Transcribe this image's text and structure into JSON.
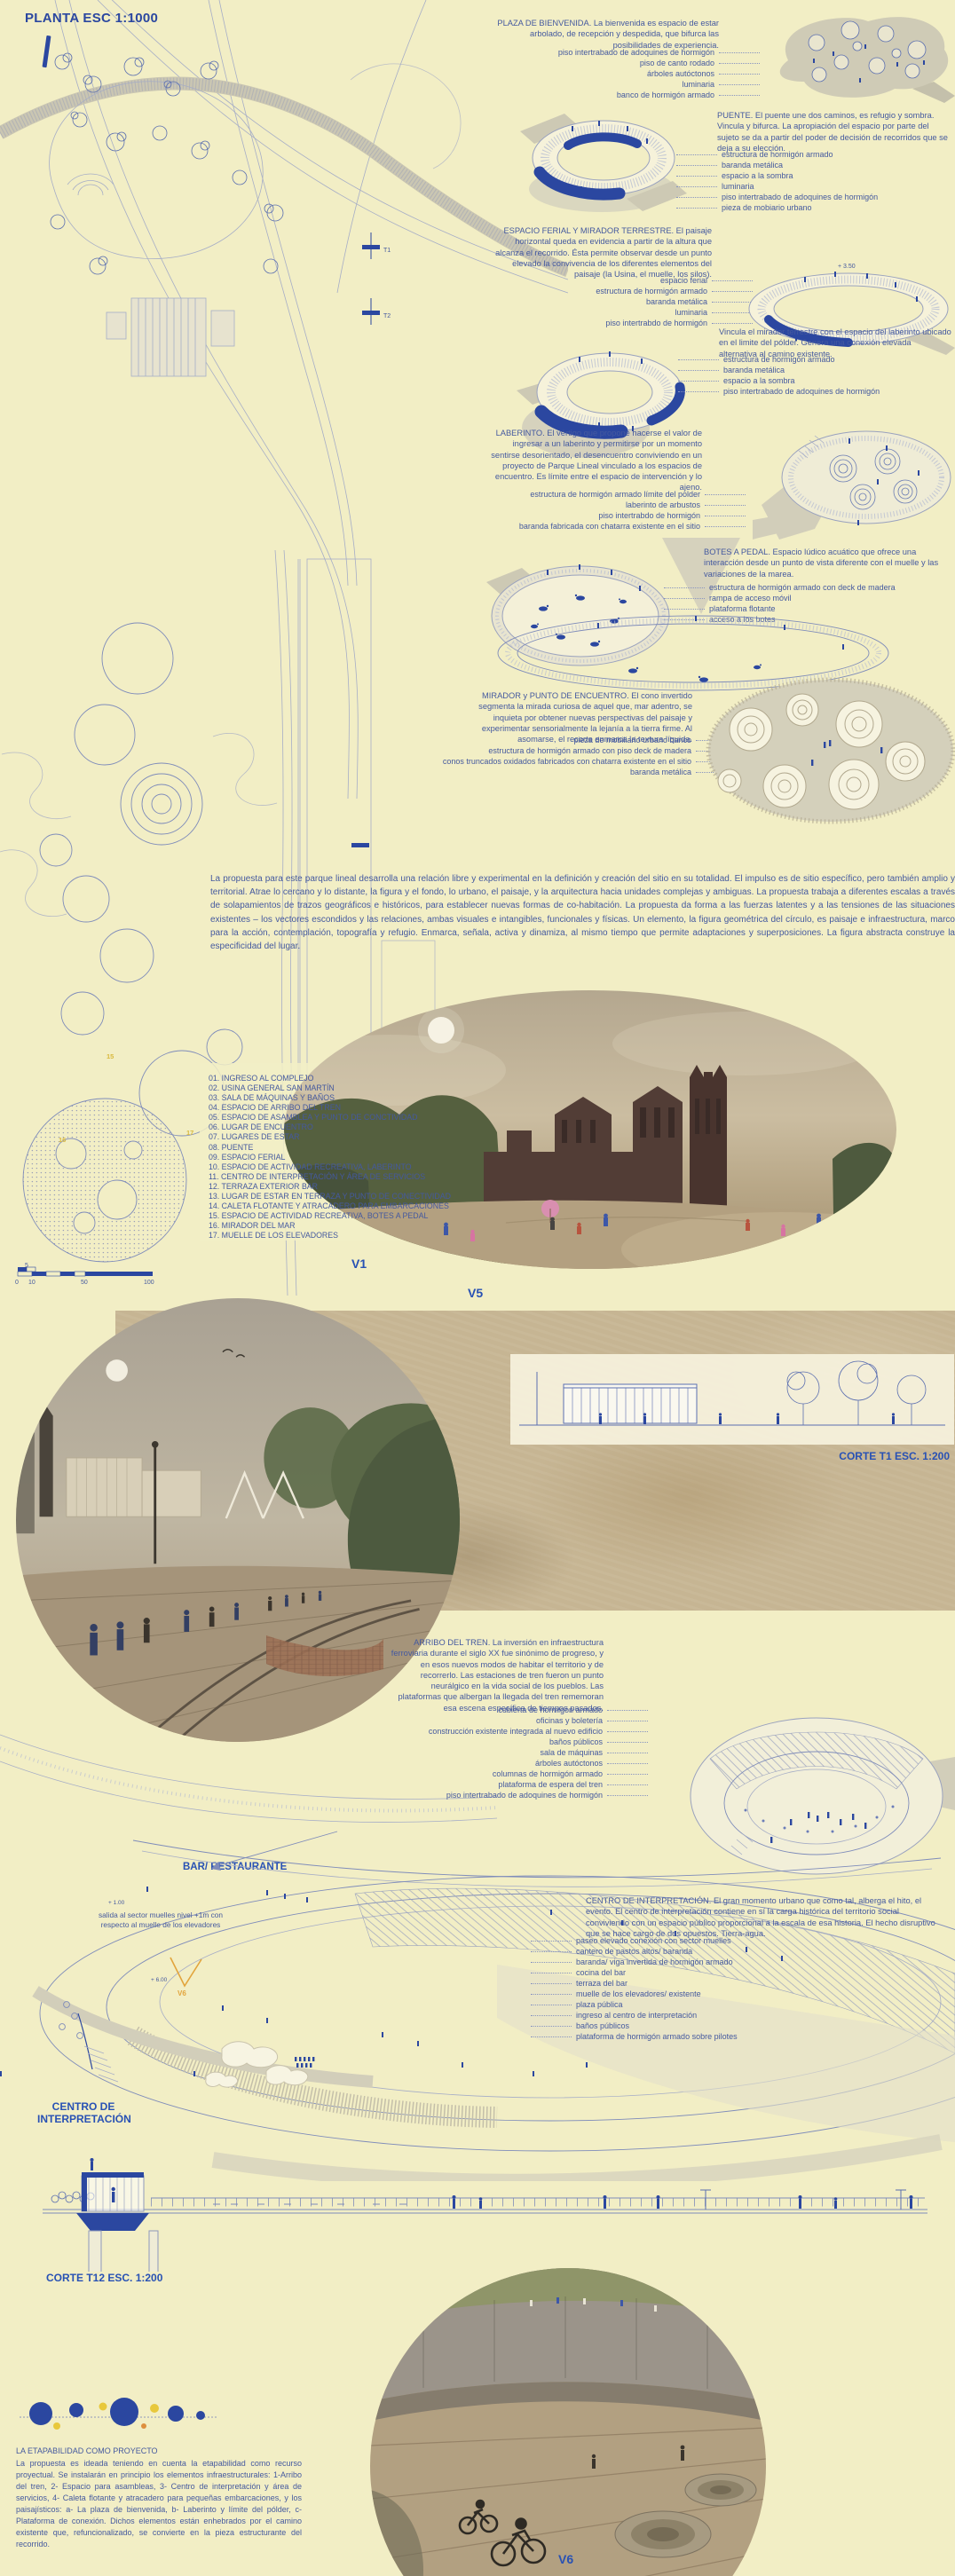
{
  "colors": {
    "background": "#f2eec5",
    "accent_blue": "#2b47a0",
    "text_blue": "#44599f",
    "band_tan": "#c6b593",
    "highlight_yellow": "#d9b93e",
    "marker_orange": "#e2a43c"
  },
  "plan": {
    "title": "PLANTA ESC 1:1000",
    "markers": [
      "15",
      "16",
      "17"
    ],
    "sections": [
      "T1",
      "T2"
    ]
  },
  "scalebar": {
    "top": "5",
    "ticks": [
      "0",
      "10",
      "50",
      "100"
    ]
  },
  "blocks": {
    "plaza": {
      "text": "PLAZA DE BIENVENIDA. La bienvenida es espacio de estar arbolado, de recepción y despedida, que bifurca las posibilidades de experiencia.",
      "labels": [
        "piso intertrabado de adoquines de hormigón",
        "piso de canto rodado",
        "árboles autóctonos",
        "luminaria",
        "banco de hormigón armado"
      ]
    },
    "puente": {
      "text": "PUENTE. El puente une dos caminos, es refugio y sombra. Vincula y bifurca. La apropiación del espacio por parte del sujeto se da a partir del poder de decisión de recorridos que se deja a su elección.",
      "labels": [
        "estructura de hormigón armado",
        "baranda metálica",
        "espacio a la sombra",
        "luminaria",
        "piso intertrabado de adoquines de hormigón",
        "pieza de mobiario urbano"
      ]
    },
    "ferial": {
      "text": "ESPACIO FERIAL Y MIRADOR TERRESTRE. El paisaje horizontal queda en evidencia a partir de la altura que alcanza el recorrido. Ésta permite observar desde un punto elevado la convivencia de los diferentes elementos del paisaje (la Usina, el muelle, los silos).",
      "labels": [
        "espacio ferial",
        "estructura de hormigón armado",
        "baranda metálica",
        "luminaria",
        "piso intertrabdo de hormigón"
      ],
      "elev": "+ 3.50"
    },
    "vincula": {
      "text": "Vincula el mirador terrestre con el espacio del laberinto ubicado en el limite del pólder. Genera una conexión elevada alternativa al camino existente.",
      "labels": [
        "estructura de hormigón armado",
        "baranda metálica",
        "espacio a la sombra",
        "piso intertrabado de adoquines de hormigón"
      ]
    },
    "laberinto": {
      "text": "LABERINTO. El vértigo que propone hacerse el valor de ingresar a un laberinto y permitirse por un momento sentirse desorientado, el desencuentro conviviendo en un proyecto de Parque Lineal vinculado a los espacios de encuentro. Es límite entre el espacio de intervención y lo ajeno.",
      "labels": [
        "estructura de hormigón armado límite del polder",
        "laberinto de arbustos",
        "piso intertrabdo de hormigón",
        "baranda fabricada con chatarra existente en el sitio"
      ]
    },
    "botes": {
      "text": "BOTES A PEDAL. Espacio lúdico acuático que ofrece una interacción desde un punto de vista diferente con el muelle y las variaciones de la marea.",
      "labels": [
        "estructura de hormigón armado con deck de madera",
        "rampa de acceso móvil",
        "plataforma flotante",
        "acceso a los botes"
      ]
    },
    "mirador": {
      "text": "MIRADOR y PUNTO DE ENCUENTRO. El cono invertido segmenta la mirada curiosa de aquel que, mar adentro, se inquieta por obtener nuevas perspectivas del paisaje y experimentar sensorialmente la lejanía a la tierra firme. Al asomarse, el recorte enmarca la textura líquida.",
      "labels": [
        "pieza de mobiliario urbano banco",
        "estructura de hormigón armado con piso deck de madera",
        "conos truncados oxidados fabricados con chatarra existente en el sitio",
        "baranda metálica"
      ]
    },
    "arribo": {
      "text": "ARRIBO DEL TREN. La inversión en infraestructura ferroviaria durante el siglo XX fue sinónimo de progreso, y en esos nuevos modos de habitar el territorio y de recorrerlo. Las estaciones de tren fueron un punto neurálgico en la vida social de los pueblos. Las plataformas que albergan la llegada del tren rememoran esa escena específica de tiempos pasados.",
      "labels": [
        "cubierta de hormigón armado",
        "oficinas y boletería",
        "construcción existente integrada al nuevo edificio",
        "baños públicos",
        "sala de máquinas",
        "árboles autóctonos",
        "columnas de hormigón armado",
        "plataforma de espera del tren",
        "piso intertrabado de adoquines de hormigón"
      ]
    },
    "centro": {
      "text": "CENTRO DE INTERPRETACIÓN. El gran momento urbano que como tal, alberga el hito, el evento. El centro de interpretación contiene en sí la carga histórica del territorio social conviviendo con un espacio público proporcional a la escala de esa historia. El hecho disruptivo que se hace cargo de dos opuestos. Tierra-agua.",
      "labels": [
        "paseo elevado conexión con sector muelles",
        "cantero de pastos altos/ baranda",
        "baranda/ viga invertida de hormigón armado",
        "cocina del bar",
        "terraza del bar",
        "muelle de los elevadores/ existente",
        "plaza pública",
        "ingreso al centro de interpretación",
        "baños públicos",
        "plataforma de hormigón armado sobre pilotes"
      ]
    }
  },
  "intro": {
    "text": "La propuesta para este parque lineal desarrolla una relación libre y experimental en la definición y creación del sitio en su totalidad. El impulso es de sitio específico, pero también amplio y territorial. Atrae lo cercano y lo distante, la figura y el fondo, lo urbano, el paisaje, y la arquitectura hacia unidades complejas y ambiguas. La propuesta trabaja a diferentes escalas a través de solapamientos de trazos geográficos e históricos, para establecer nuevas formas de co-habitación. La propuesta da forma a las fuerzas latentes y a las tensiones de las situaciones existentes – los vectores escondidos y las relaciones, ambas visuales e intangibles, funcionales y físicas. Un elemento, la figura geométrica del círculo, es paisaje e infraestructura, marco para la acción, contemplación, topografía y refugio. Enmarca, señala, activa y dinamiza, al mismo tiempo que permite adaptaciones y superposiciones. La figura abstracta construye la especificidad del lugar."
  },
  "legend": {
    "items": [
      "01. INGRESO AL COMPLEJO",
      "02. USINA GENERAL SAN MARTÍN",
      "03. SALA DE MÁQUINAS Y BAÑOS",
      "04. ESPACIO DE ARRIBO DEL TREN",
      "05. ESPACIO DE ASAMBLEA Y PUNTO DE CONCTIVIDAD",
      "06. LUGAR DE ENCUENTRO",
      "07. LUGARES DE ESTAR",
      "08. PUENTE",
      "09. ESPACIO FERIAL",
      "10. ESPACIO DE ACTIVIDAD RECREATIVA, LABERINTO",
      "11. CENTRO DE INTERPRETACIÓN Y ÁREA DE SERVICIOS",
      "12. TERRAZA EXTERIOR BAR",
      "13. LUGAR DE ESTAR EN TERRAZA Y PUNTO DE CONECTIVIDAD",
      "14. CALETA FLOTANTE Y ATRACADERO PARA EMBARCACIONES",
      "15. ESPACIO DE ACTIVIDAD RECREATIVA, BOTES A PEDAL",
      "16. MIRADOR DEL MAR",
      "17. MUELLE DE LOS ELEVADORES"
    ]
  },
  "views": {
    "v1": "V1",
    "v5": "V5",
    "v6": "V6",
    "v6_axon": "V6"
  },
  "cortes": {
    "t1": "CORTE T1 ESC. 1:200",
    "t12": "CORTE T12 ESC. 1:200"
  },
  "bar": {
    "label": "BAR/ RESTAURANTE"
  },
  "centro_label": {
    "line1": "CENTRO DE",
    "line2": "INTERPRETACIÓN",
    "salida_note": "salida al sector muelles nivel +1m con respecto al muelle de los elevadores",
    "elev1": "+ 1.00",
    "elev2": "+ 6.00"
  },
  "etapa": {
    "title": "LA ETAPABILIDAD COMO PROYECTO",
    "text": "La propuesta es ideada teniendo en cuenta la etapabilidad como recurso proyectual. Se instalarán en principio los elementos infraestructurales: 1-Arribo del tren, 2- Espacio para asambleas, 3- Centro de interpretación y área de servicios, 4- Caleta flotante y atracadero para pequeñas embarcaciones, y los paisajísticos: a- La plaza de bienvenida, b- Laberinto y límite del pólder, c- Plataforma de conexión. Dichos elementos están enhebrados por el camino existente que, refuncionalizado, se convierte en la pieza estructurante del recorrido."
  }
}
